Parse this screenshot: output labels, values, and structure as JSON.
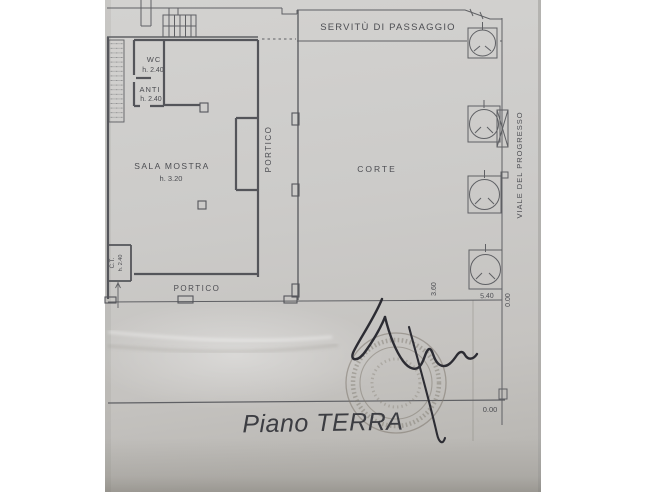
{
  "plan": {
    "title": "Piano TERRA",
    "site_labels": {
      "servitu": "SERVITÙ DI PASSAGGIO",
      "viale": "VIALE DEL PROGRESSO",
      "corte": "CORTE",
      "portico_side": "PORTICO",
      "portico_bottom": "PORTICO"
    },
    "rooms": {
      "wc": {
        "name": "WC",
        "height": "h. 2.40"
      },
      "anti": {
        "name": "ANTI",
        "height": "h. 2.40"
      },
      "sala_mostra": {
        "name": "SALA MOSTRA",
        "height": "h. 3.20"
      },
      "ct": {
        "name": "C.T.",
        "height": "h. 2.40"
      }
    },
    "dimensions": {
      "west_offset": "3.60",
      "south_offset": "5.40",
      "corner_level": "0.00",
      "ground_level": "0.00"
    },
    "colors": {
      "paper": "#cbcac8",
      "ink": "#5c5d61",
      "signature_ink": "#2c2c33"
    }
  }
}
